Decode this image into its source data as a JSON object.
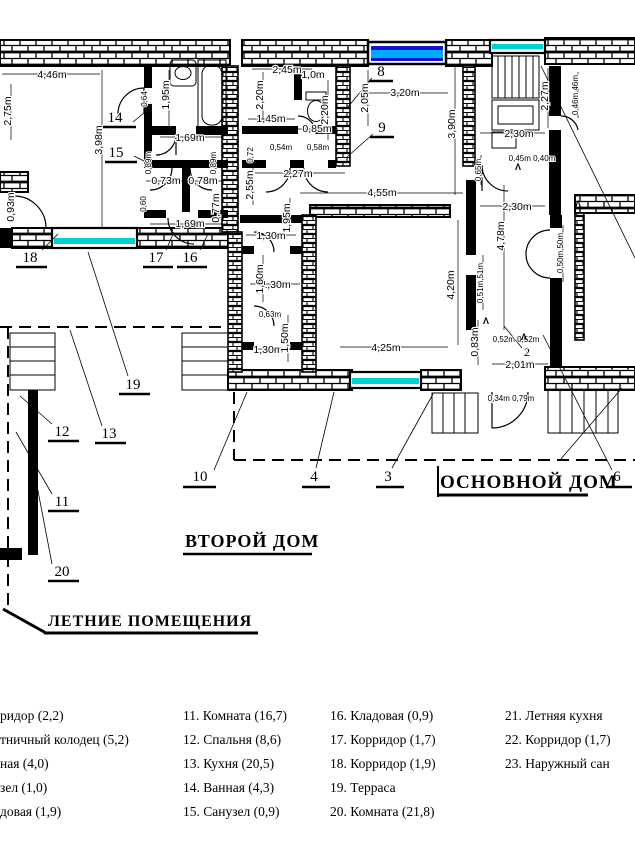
{
  "section_labels": {
    "second_house": "ВТОРОЙ ДОМ",
    "main_house": "ОСНОВНОЙ ДОМ",
    "summer_rooms": "ЛЕТНИЕ ПОМЕЩЕНИЯ"
  },
  "rooms": {
    "n2": "2",
    "n3": "3",
    "n4": "4",
    "n6": "6",
    "n8": "8",
    "n9": "9",
    "n10": "10",
    "n11": "11",
    "n12": "12",
    "n13": "13",
    "n14": "14",
    "n15": "15",
    "n16": "16",
    "n17": "17",
    "n18": "18",
    "n19": "19",
    "n20": "20"
  },
  "dims": {
    "h446": "4,46m",
    "h169a": "1,69m",
    "h073": "0,73m",
    "h078": "0,78m",
    "h169b": "1,69m",
    "h245": "2,45m",
    "h10": "1,0m",
    "h145": "1,45m",
    "h085": "0,85m",
    "h054": "0,54m",
    "h058": "0,58m",
    "h227": "2,27m",
    "h455": "4,55m",
    "h320": "3,20m",
    "h230a": "2,30m",
    "h230b": "2,30m",
    "h4540": "0,45m 0,40m",
    "h130a": "1,30m",
    "h130b": "1,30m",
    "h063": "0,63m",
    "h130c": "1,30m",
    "h425": "4,25m",
    "h5252": "0,52m 0,52m",
    "h201": "2,01m",
    "h3479": "0,34m 0,79m",
    "v275": "2,75m",
    "v398": "3,98m",
    "v195a": "1,95m",
    "v064": "0,64",
    "v089a": "0,89m",
    "v089b": "0,89m",
    "v093": "0,93m",
    "v060": "0,60",
    "v077": "0,77m",
    "v220a": "2,20m",
    "v220b": "2,20m",
    "v205": "2,05m",
    "v390": "3,90m",
    "v255": "2,55m",
    "v072": "0,72",
    "v195b": "1,95m",
    "v227": "2,27m",
    "v4646": "0,46m,46m",
    "v065": "0,65m",
    "v160": "1,60m",
    "v150": "1,50m",
    "v420": "4,20m",
    "v478": "4,78m",
    "v5151": "0,51m,51m",
    "v5050": "0,50m,50m",
    "v083": "0,83m"
  },
  "icons": {
    "door_swing_arrow": "Λ"
  },
  "colors": {
    "wall": "#000000",
    "window_blue_dark": "#1414cc",
    "window_blue_light": "#00aaff",
    "window_cyan": "#00d2d2"
  },
  "legend": {
    "col1": [
      "ридор (2,2)",
      "тничный колодец (5,2)",
      "ная  (4,0)",
      "зел  (1,0)",
      "довая (1,9)"
    ],
    "col2": [
      "11. Комната (16,7)",
      "12. Спальня (8,6)",
      "13. Кухня (20,5)",
      "14. Ванная (4,3)",
      "15. Санузел (0,9)"
    ],
    "col3": [
      "16. Кладовая (0,9)",
      "17. Корридор (1,7)",
      "18. Корридор (1,9)",
      "19. Терраса",
      "20. Комната  (21,8)"
    ],
    "col4": [
      "21. Летняя кухня",
      "22. Корридор (1,7)",
      "23. Наружный сан"
    ]
  }
}
